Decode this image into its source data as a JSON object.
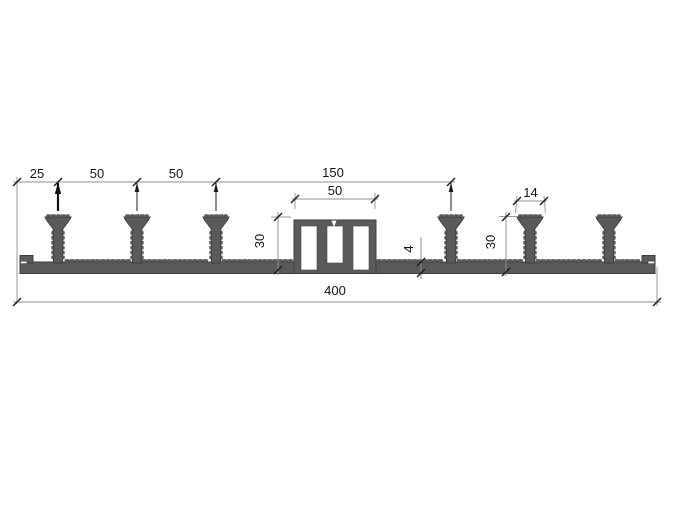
{
  "colors": {
    "background": "#ffffff",
    "profile_fill": "#5a5a5a",
    "profile_outline": "#3e3e3e",
    "dimension_line": "#8f8f8f",
    "dimension_text": "#141414"
  },
  "dimensions": {
    "top_left_offset": "25",
    "rib_pitch_left_1": "50",
    "rib_pitch_left_2": "50",
    "center_span": "150",
    "center_bulb_width": "50",
    "rib_head_width": "14",
    "profile_height_left": "30",
    "profile_height_right": "30",
    "base_thickness": "4",
    "total_width": "400"
  }
}
